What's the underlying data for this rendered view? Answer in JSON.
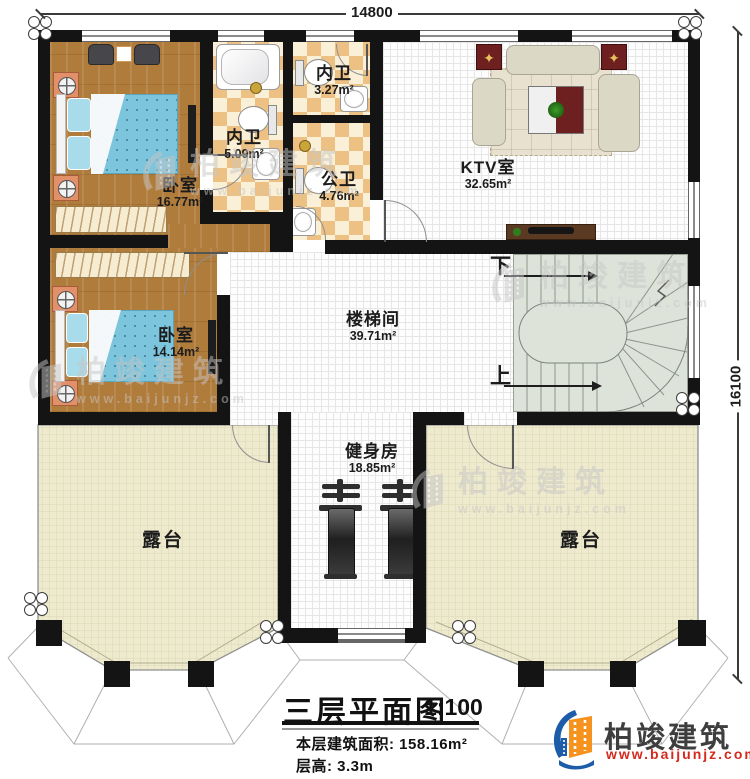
{
  "dimensions": {
    "top": "14800",
    "right": "16100"
  },
  "rooms": {
    "bedroom1": {
      "name": "卧室",
      "area": "16.77m²"
    },
    "ensuite_master": {
      "name": "内卫",
      "area": "5.09m²"
    },
    "ensuite_small": {
      "name": "内卫",
      "area": "3.27m²"
    },
    "public_bath": {
      "name": "公卫",
      "area": "4.76m²"
    },
    "ktv": {
      "name": "KTV室",
      "area": "32.65m²"
    },
    "stair_hall": {
      "name": "楼梯间",
      "area": "39.71m²"
    },
    "bedroom2": {
      "name": "卧室",
      "area": "14.14m²"
    },
    "gym": {
      "name": "健身房",
      "area": "18.85m²"
    },
    "terrace_left": {
      "name": "露台"
    },
    "terrace_right": {
      "name": "露台"
    }
  },
  "stairs": {
    "down": "下",
    "up": "上"
  },
  "title_block": {
    "title": "三层平面图",
    "scale": "1:100",
    "area_label": "本层建筑面积:",
    "area_value": "158.16m²",
    "height_label": "层高:",
    "height_value": "3.3m"
  },
  "brand": {
    "name": "柏竣建筑",
    "website": "www.baijunjz.com"
  },
  "watermark": {
    "name": "柏竣建筑",
    "website": "www.baijunjz.com"
  },
  "colors": {
    "wall": "#141414",
    "wood": "#b07c3c",
    "bed": "#7cc5dc",
    "checkerA": "#ecc183",
    "checkerB": "#faefd7",
    "grid_floor": "#fdfdfd",
    "grid_line": "#e6e6e6",
    "terrace": "#edeacd",
    "terrace_line": "#ddd7b8",
    "stair": "#dde3d9",
    "accent_red": "#6e2020",
    "logo_blue": "#1c5ca8",
    "logo_orange": "#f6921e",
    "logo_red": "#d42a1e",
    "watermark_gray": "#c6c6c6"
  }
}
